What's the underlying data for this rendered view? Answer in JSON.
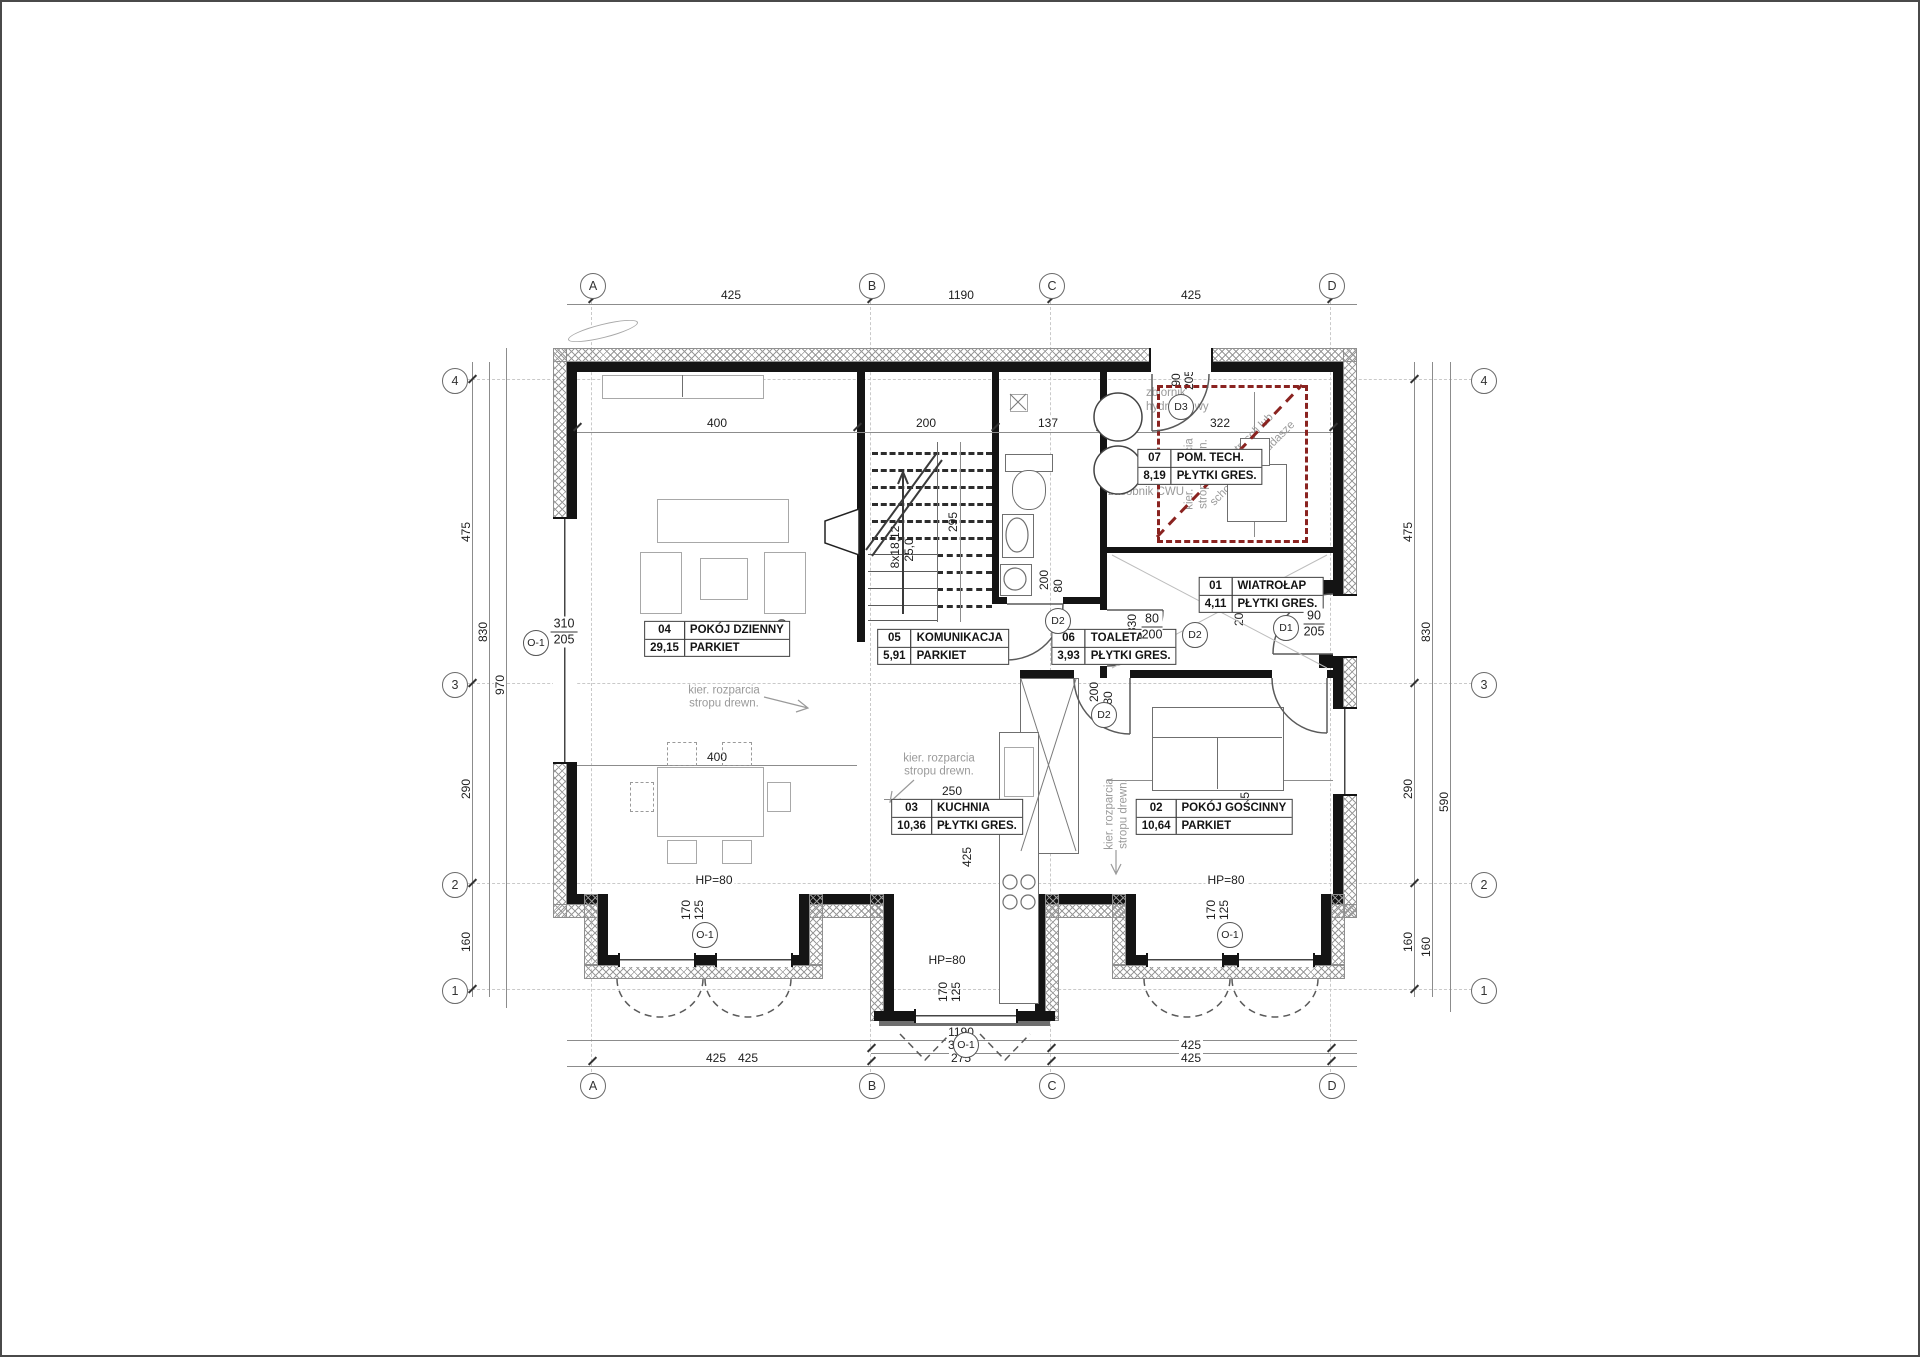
{
  "axes": {
    "cols": [
      "A",
      "B",
      "C",
      "D"
    ],
    "rows": [
      "4",
      "3",
      "2",
      "1"
    ]
  },
  "rooms": [
    {
      "no": "01",
      "name": "WIATROŁAP",
      "area": "4,11",
      "floor": "PŁYTKI GRES."
    },
    {
      "no": "02",
      "name": "POKÓJ GOŚCINNY",
      "area": "10,64",
      "floor": "PARKIET"
    },
    {
      "no": "03",
      "name": "KUCHNIA",
      "area": "10,36",
      "floor": "PŁYTKI GRES."
    },
    {
      "no": "04",
      "name": "POKÓJ DZIENNY",
      "area": "29,15",
      "floor": "PARKIET"
    },
    {
      "no": "05",
      "name": "KOMUNIKACJA",
      "area": "5,91",
      "floor": "PARKIET"
    },
    {
      "no": "06",
      "name": "TOALETA",
      "area": "3,93",
      "floor": "PŁYTKI GRES."
    },
    {
      "no": "07",
      "name": "POM. TECH.",
      "area": "8,19",
      "floor": "PŁYTKI GRES."
    }
  ],
  "dims": {
    "top": {
      "ab": "425",
      "overall": "1190",
      "cd": "425"
    },
    "bottom": {
      "overall": "1190",
      "porch": "340",
      "cd2": "425",
      "ab": "425",
      "ab2": "425",
      "bc": "275",
      "cd": "425"
    },
    "left": {
      "a": "475",
      "b": "290",
      "c": "160",
      "mid": "830",
      "overall": "970"
    },
    "right": {
      "a": "475",
      "b": "290",
      "c": "160",
      "mid": "830",
      "low": "590",
      "bot": "160"
    },
    "inner": {
      "living": "400",
      "hall": "200",
      "toilet": "137",
      "tech": "322",
      "tech_h": "242",
      "stair": "295",
      "stair_n1": "8x18,12",
      "stair_n2": "25,0",
      "living_len": "740",
      "living2": "400",
      "kitchen": "250",
      "kitchen_h": "425",
      "guest": "417",
      "guest_h": "265",
      "corr": "830",
      "w200": "200",
      "w80": "80"
    }
  },
  "openings": {
    "d1": "D1",
    "d2": "D2",
    "d3": "D3",
    "o1": "O-1",
    "d1w": "90",
    "d1h": "205",
    "d2w": "80",
    "d2h": "200",
    "d3w": "90",
    "d3h": "205",
    "o1w": "310",
    "o1h": "205",
    "bw": "170",
    "bh": "125",
    "hp": "HP=80"
  },
  "annot": {
    "tank1": "zbiornik",
    "tank1b": "hydroforowy",
    "tank2": "zasobnik CWU",
    "k1": "kier. rozparcia",
    "k2": "stropu drewn.",
    "a1": "obrys antresoli lub",
    "a2": "schodów na poddasze"
  },
  "colors": {
    "wall": "#141414",
    "red_zone": "#8a2320",
    "annotation_gray": "#9a9a9a"
  }
}
